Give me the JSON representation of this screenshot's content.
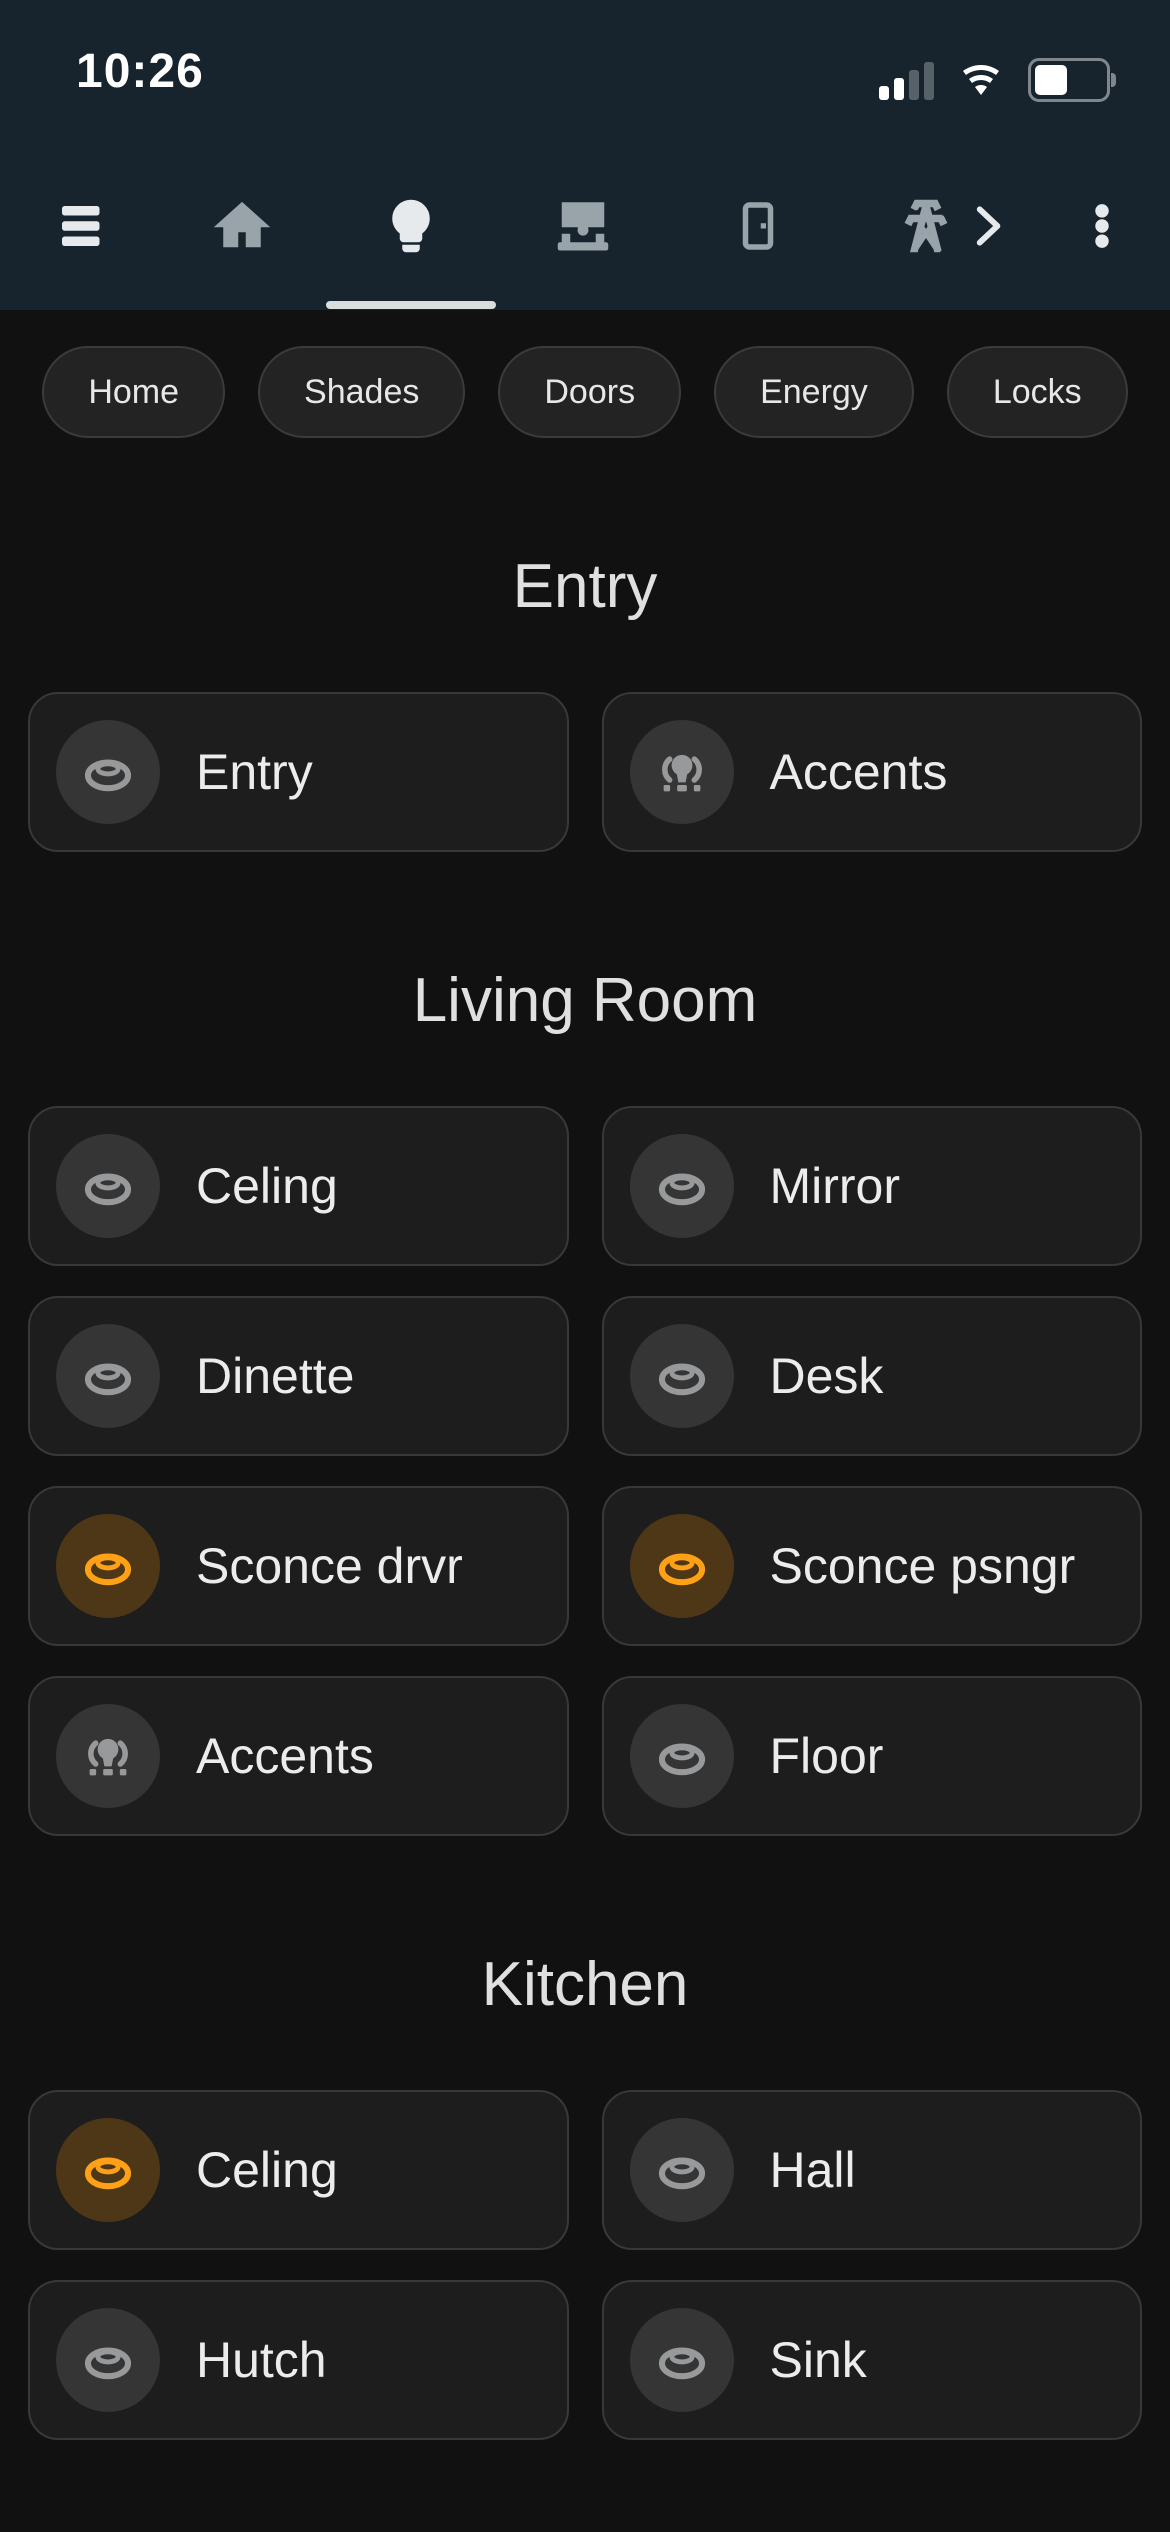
{
  "status_bar": {
    "time": "10:26"
  },
  "nav": {
    "active_tab": "lights",
    "tabs": [
      {
        "icon": "hamburger-menu-icon"
      },
      {
        "icon": "home-icon"
      },
      {
        "icon": "lightbulb-icon",
        "active": true
      },
      {
        "icon": "roller-shade-icon"
      },
      {
        "icon": "door-icon"
      },
      {
        "icon": "transmission-tower-icon"
      },
      {
        "icon": "chevron-right-icon"
      },
      {
        "icon": "dots-vertical-icon"
      }
    ]
  },
  "chips": {
    "items": [
      {
        "label": "Home"
      },
      {
        "label": "Shades"
      },
      {
        "label": "Doors"
      },
      {
        "label": "Energy"
      },
      {
        "label": "Locks"
      }
    ]
  },
  "sections": [
    {
      "title": "Entry",
      "tiles": [
        {
          "name": "Entry",
          "icon": "ceiling-light-icon",
          "state": "off"
        },
        {
          "name": "Accents",
          "icon": "vanity-light-icon",
          "state": "off"
        }
      ]
    },
    {
      "title": "Living Room",
      "tiles": [
        {
          "name": "Celing",
          "icon": "ceiling-light-icon",
          "state": "off"
        },
        {
          "name": "Mirror",
          "icon": "ceiling-light-icon",
          "state": "off"
        },
        {
          "name": "Dinette",
          "icon": "ceiling-light-icon",
          "state": "off"
        },
        {
          "name": "Desk",
          "icon": "ceiling-light-icon",
          "state": "off"
        },
        {
          "name": "Sconce drvr",
          "icon": "ceiling-light-icon",
          "state": "on"
        },
        {
          "name": "Sconce psngr",
          "icon": "ceiling-light-icon",
          "state": "on"
        },
        {
          "name": "Accents",
          "icon": "vanity-light-icon",
          "state": "off"
        },
        {
          "name": "Floor",
          "icon": "ceiling-light-icon",
          "state": "off"
        }
      ]
    },
    {
      "title": "Kitchen",
      "tiles": [
        {
          "name": "Celing",
          "icon": "ceiling-light-icon",
          "state": "on"
        },
        {
          "name": "Hall",
          "icon": "ceiling-light-icon",
          "state": "off"
        },
        {
          "name": "Hutch",
          "icon": "ceiling-light-icon",
          "state": "off"
        },
        {
          "name": "Sink",
          "icon": "ceiling-light-icon",
          "state": "off"
        }
      ]
    }
  ],
  "colors": {
    "accent_on": "#ffa117",
    "navbar_bg": "#17242e",
    "page_bg": "#111111",
    "tile_bg": "#1d1d1d"
  }
}
